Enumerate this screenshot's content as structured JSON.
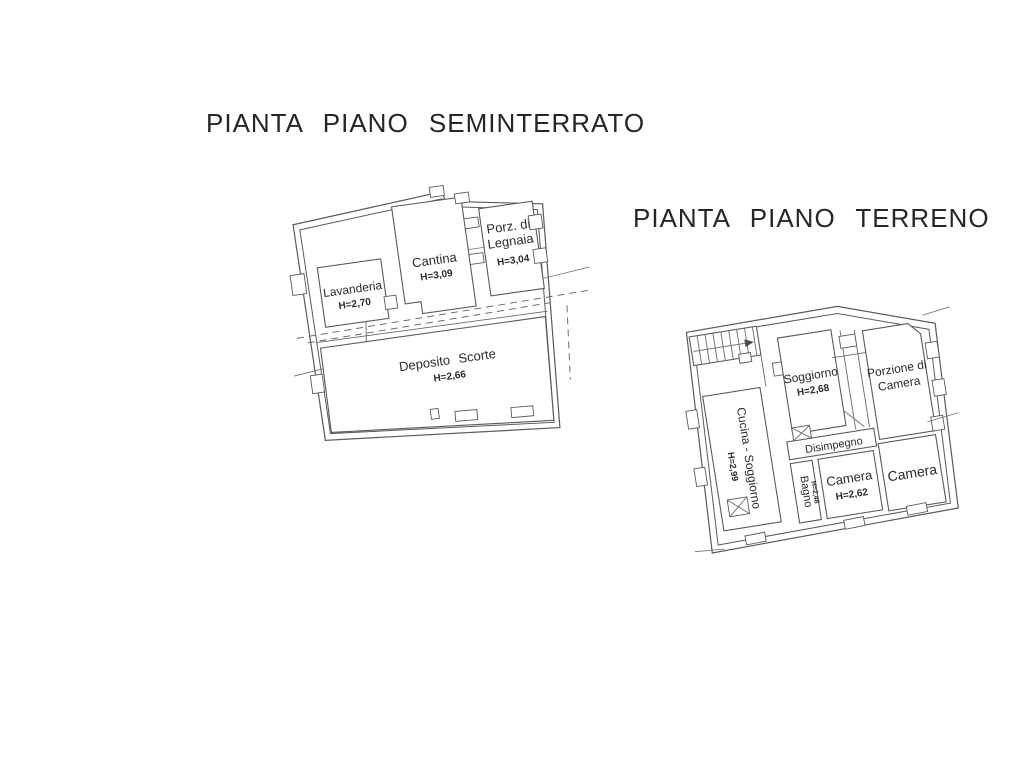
{
  "seminterrato": {
    "title": "PIANTA PIANO SEMINTERRATO",
    "rooms": {
      "lavanderia": {
        "label": "Lavanderia",
        "h": "H=2,70"
      },
      "cantina": {
        "label": "Cantina",
        "h": "H=3,09"
      },
      "legnaia": {
        "label1": "Porz. di",
        "label2": "Legnaia",
        "h": "H=3,04"
      },
      "deposito": {
        "label": "Deposito Scorte",
        "h": "H=2,66"
      }
    }
  },
  "terreno": {
    "title": "PIANTA PIANO TERRENO",
    "rooms": {
      "soggiorno": {
        "label": "Soggiorno",
        "h": "H=2,68"
      },
      "porzione": {
        "label1": "Porzione di",
        "label2": "Camera"
      },
      "cucina": {
        "label": "Cucina - Soggiorno",
        "h": "H=2,99"
      },
      "disimpegno": {
        "label": "Disimpegno"
      },
      "bagno": {
        "label": "Bagno",
        "h": "H=2,48"
      },
      "camera1": {
        "label": "Camera",
        "h": "H=2,62"
      },
      "camera2": {
        "label": "Camera"
      }
    }
  },
  "colors": {
    "line": "#5a5a5a",
    "text": "#2a2a2a",
    "title": "#262626",
    "background": "#ffffff"
  }
}
